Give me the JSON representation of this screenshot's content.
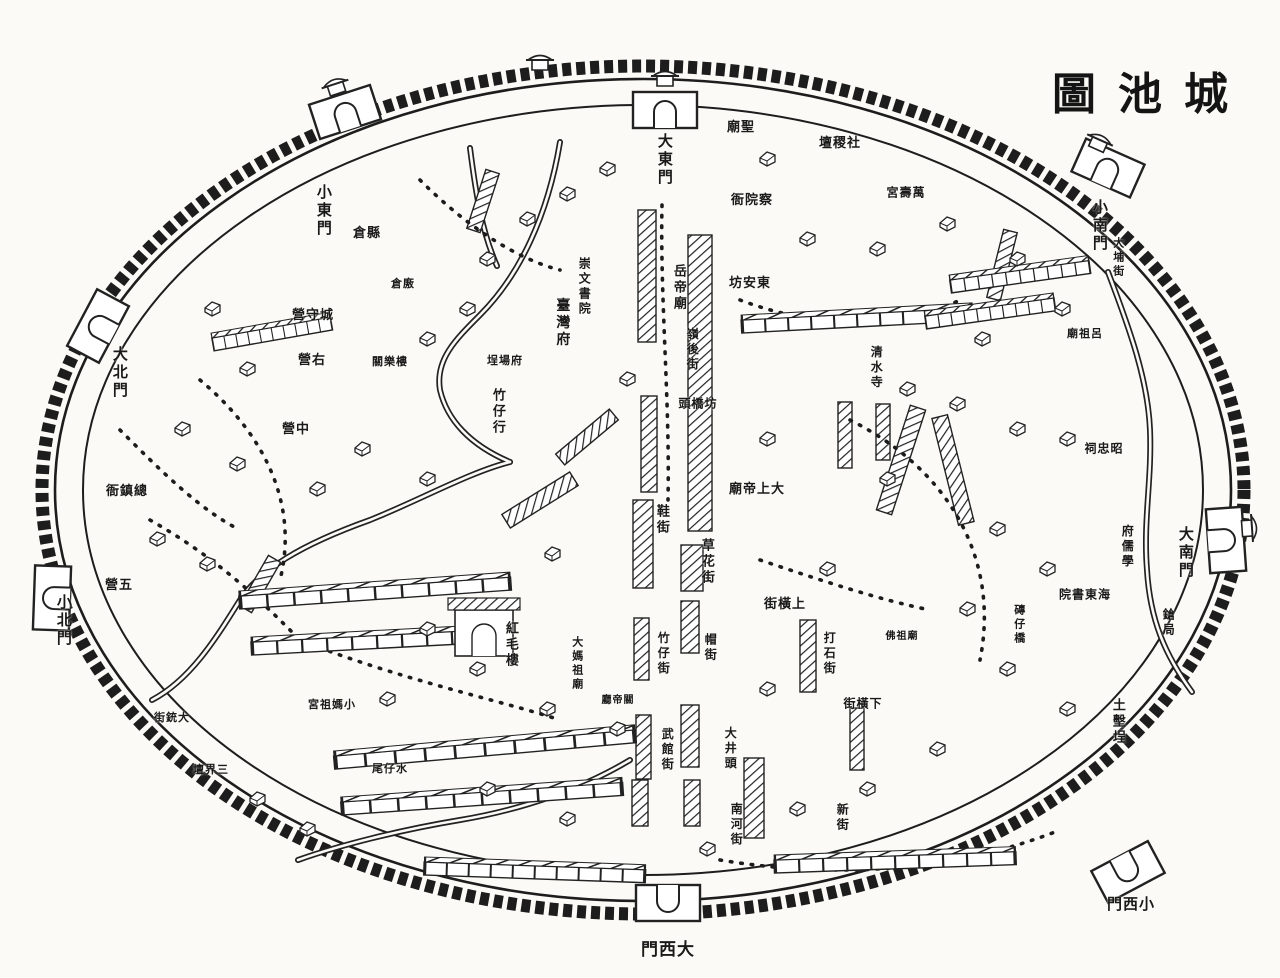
{
  "title": {
    "display": "圖池城",
    "reading": "城池圖"
  },
  "colors": {
    "paper": "#fbfaf6",
    "ink": "#1a1a1a"
  },
  "map": {
    "gates": [
      {
        "text": "大東門",
        "o": "v",
        "x": 663,
        "y": 160
      },
      {
        "text": "小東門",
        "o": "v",
        "x": 322,
        "y": 211
      },
      {
        "text": "大北門",
        "o": "v",
        "x": 118,
        "y": 373
      },
      {
        "text": "小北門",
        "o": "v",
        "x": 62,
        "y": 621
      },
      {
        "text": "大南門",
        "o": "v",
        "x": 1184,
        "y": 553
      },
      {
        "text": "小南門",
        "o": "v",
        "x": 1098,
        "y": 226
      },
      {
        "text": "門西大",
        "reading": "大西門",
        "o": "h",
        "x": 668,
        "y": 950,
        "size": 17
      },
      {
        "text": "門西小",
        "reading": "小西門",
        "o": "h",
        "x": 1131,
        "y": 906
      }
    ],
    "labels": [
      {
        "text": "營守城",
        "reading": "城守營",
        "o": "h",
        "x": 313,
        "y": 315
      },
      {
        "text": "營右",
        "reading": "右營",
        "o": "h",
        "x": 312,
        "y": 360
      },
      {
        "text": "營中",
        "reading": "中營",
        "o": "h",
        "x": 296,
        "y": 429
      },
      {
        "text": "衙鎮總",
        "reading": "總鎮衙",
        "o": "h",
        "x": 127,
        "y": 491
      },
      {
        "text": "營五",
        "reading": "五營",
        "o": "h",
        "x": 119,
        "y": 585
      },
      {
        "text": "倉縣",
        "reading": "縣倉",
        "o": "h",
        "x": 367,
        "y": 233
      },
      {
        "text": "倉廒",
        "o": "h",
        "x": 403,
        "y": 285,
        "size": 11
      },
      {
        "text": "關樂樓",
        "o": "h",
        "x": 390,
        "y": 363,
        "size": 11
      },
      {
        "text": "臺灣府",
        "o": "v",
        "x": 561,
        "y": 323,
        "size": 14
      },
      {
        "text": "崇文書院",
        "o": "v",
        "x": 584,
        "y": 287,
        "size": 12
      },
      {
        "text": "埕場府",
        "reading": "府場埕",
        "o": "h",
        "x": 505,
        "y": 362,
        "size": 11
      },
      {
        "text": "竹仔行",
        "o": "v",
        "x": 498,
        "y": 412
      },
      {
        "text": "岳帝廟",
        "o": "v",
        "x": 679,
        "y": 288
      },
      {
        "text": "嶺後街",
        "o": "v",
        "x": 692,
        "y": 350,
        "size": 12
      },
      {
        "text": "坊安東",
        "reading": "東安坊",
        "o": "h",
        "x": 750,
        "y": 283
      },
      {
        "text": "衙院察",
        "reading": "察院衙",
        "o": "h",
        "x": 752,
        "y": 200
      },
      {
        "text": "廟聖",
        "reading": "聖廟",
        "o": "h",
        "x": 741,
        "y": 127
      },
      {
        "text": "壇稷社",
        "reading": "社稷壇",
        "o": "h",
        "x": 840,
        "y": 143
      },
      {
        "text": "宮壽萬",
        "reading": "萬壽宮",
        "o": "h",
        "x": 906,
        "y": 193,
        "size": 12
      },
      {
        "text": "廟祖呂",
        "reading": "呂祖廟",
        "o": "h",
        "x": 1085,
        "y": 335,
        "size": 11
      },
      {
        "text": "清水寺",
        "o": "v",
        "x": 876,
        "y": 368,
        "size": 12
      },
      {
        "text": "祠忠昭",
        "reading": "昭忠祠",
        "o": "h",
        "x": 1104,
        "y": 449,
        "size": 12
      },
      {
        "text": "府儒學",
        "o": "v",
        "x": 1127,
        "y": 547,
        "size": 12
      },
      {
        "text": "院書東海",
        "reading": "海東書院",
        "o": "h",
        "x": 1085,
        "y": 595,
        "size": 12
      },
      {
        "text": "磚仔橋",
        "o": "v",
        "x": 1018,
        "y": 625,
        "size": 11
      },
      {
        "text": "鎗局",
        "o": "v",
        "x": 1168,
        "y": 623,
        "size": 12
      },
      {
        "text": "土墼埕",
        "o": "v",
        "x": 1118,
        "y": 722
      },
      {
        "text": "大埔街",
        "o": "v",
        "x": 1117,
        "y": 258,
        "size": 11
      },
      {
        "text": "頭橋坊",
        "reading": "坊橋頭",
        "o": "h",
        "x": 698,
        "y": 404,
        "size": 12
      },
      {
        "text": "廟帝上大",
        "reading": "大上帝廟",
        "o": "h",
        "x": 757,
        "y": 489
      },
      {
        "text": "鞋街",
        "o": "v",
        "x": 662,
        "y": 520
      },
      {
        "text": "草花街",
        "o": "v",
        "x": 707,
        "y": 562
      },
      {
        "text": "街橫上",
        "reading": "上橫街",
        "o": "h",
        "x": 785,
        "y": 604
      },
      {
        "text": "街橫下",
        "reading": "下橫街",
        "o": "h",
        "x": 863,
        "y": 704,
        "size": 12
      },
      {
        "text": "打石街",
        "o": "v",
        "x": 829,
        "y": 654,
        "size": 12
      },
      {
        "text": "竹仔街",
        "o": "v",
        "x": 663,
        "y": 654,
        "size": 12
      },
      {
        "text": "帽街",
        "o": "v",
        "x": 710,
        "y": 648,
        "size": 12
      },
      {
        "text": "武館街",
        "o": "v",
        "x": 667,
        "y": 750,
        "size": 12
      },
      {
        "text": "大井頭",
        "o": "v",
        "x": 730,
        "y": 749,
        "size": 12
      },
      {
        "text": "南河街",
        "o": "v",
        "x": 736,
        "y": 825,
        "size": 12
      },
      {
        "text": "新街",
        "o": "v",
        "x": 842,
        "y": 818,
        "size": 12
      },
      {
        "text": "佛祖廟",
        "o": "h",
        "x": 902,
        "y": 637,
        "size": 10
      },
      {
        "text": "大媽祖廟",
        "o": "v",
        "x": 576,
        "y": 664,
        "size": 11
      },
      {
        "text": "廳帝關",
        "reading": "關帝廳",
        "o": "h",
        "x": 618,
        "y": 701,
        "size": 10
      },
      {
        "text": "宮祖媽小",
        "reading": "小媽祖宮",
        "o": "h",
        "x": 332,
        "y": 706,
        "size": 11
      },
      {
        "text": "尾仔水",
        "reading": "水仔尾",
        "o": "h",
        "x": 390,
        "y": 770,
        "size": 11
      },
      {
        "text": "街銃大",
        "reading": "大銃街",
        "o": "h",
        "x": 172,
        "y": 719,
        "size": 11
      },
      {
        "text": "壇界三",
        "reading": "三界壇",
        "o": "h",
        "x": 211,
        "y": 771,
        "size": 11
      },
      {
        "text": "紅毛樓",
        "o": "v",
        "x": 511,
        "y": 645
      }
    ]
  }
}
